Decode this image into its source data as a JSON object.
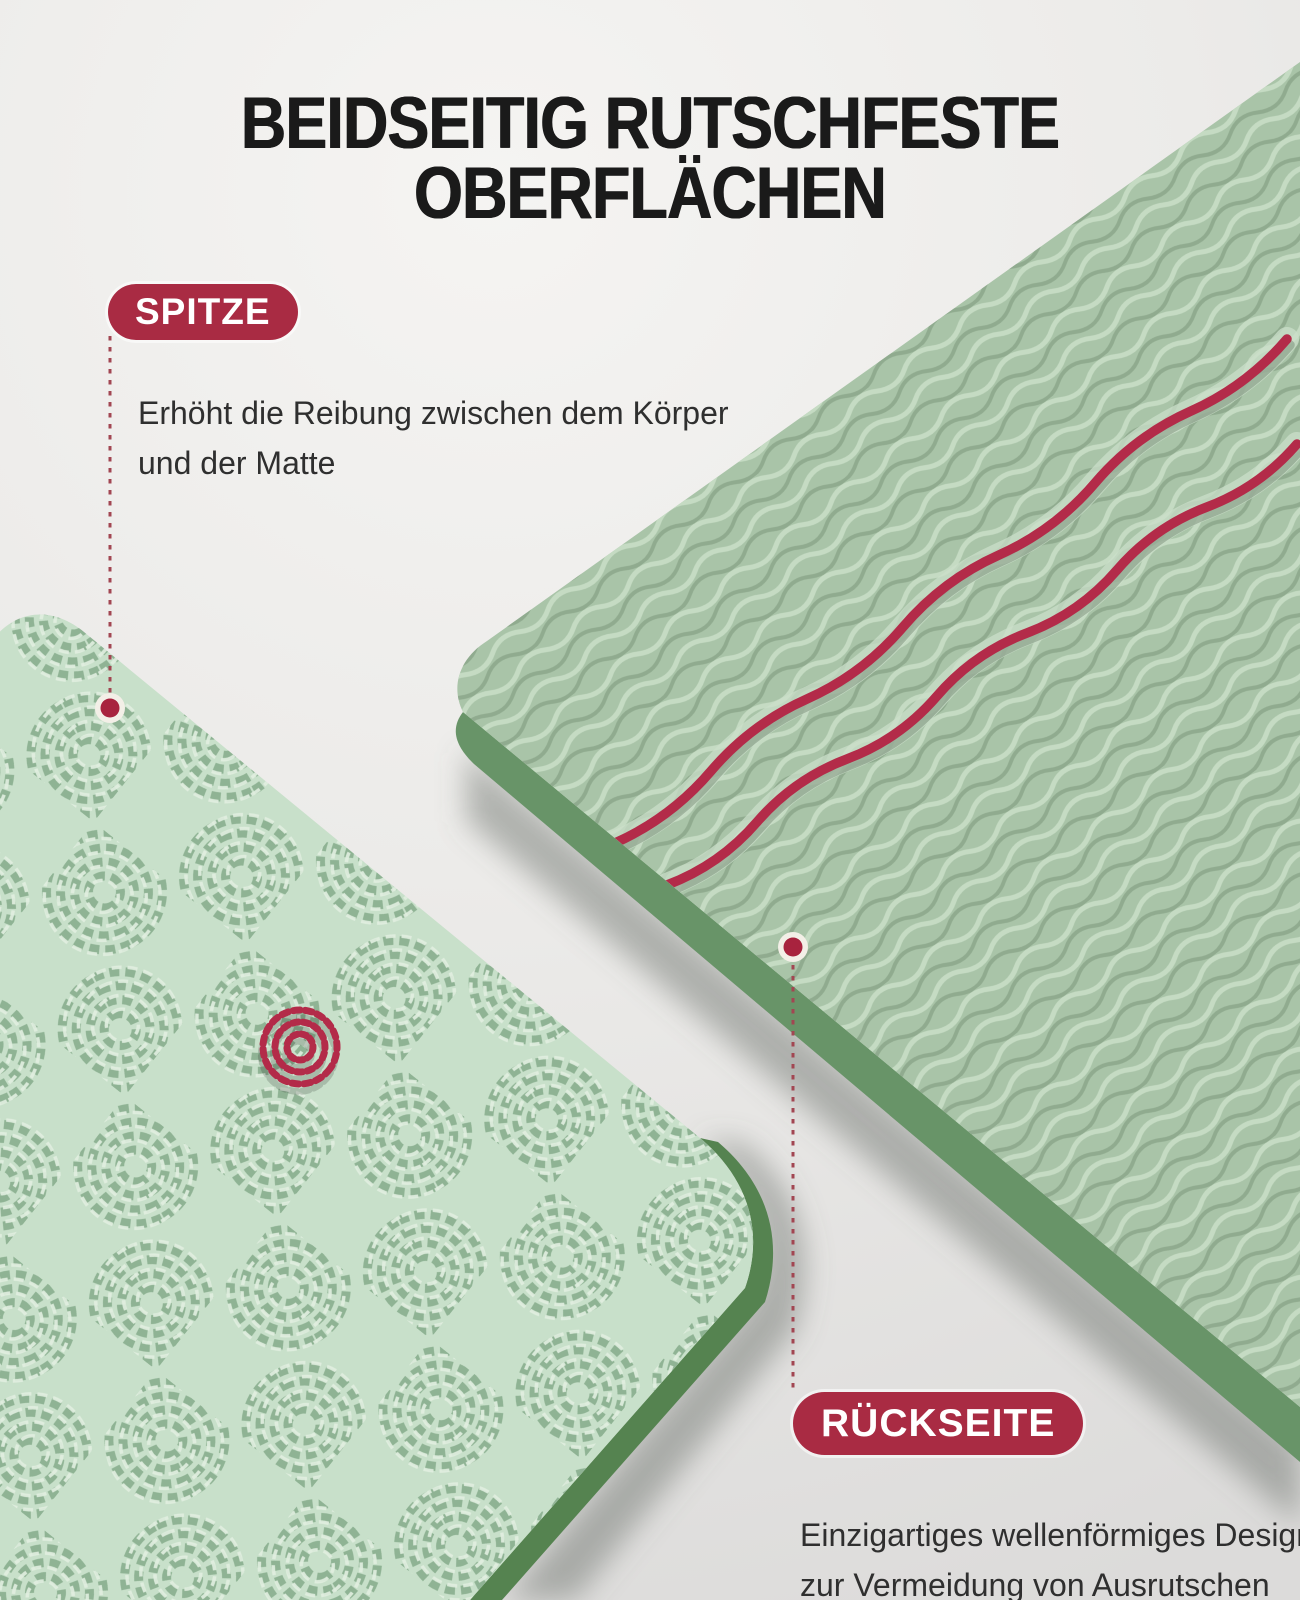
{
  "title": {
    "line1": "BEIDSEITIG RUTSCHFESTE",
    "line2": "OBERFLÄCHEN"
  },
  "callouts": {
    "spitze": {
      "label": "SPITZE",
      "description": "Erhöht die Reibung zwischen dem Körper und der Matte"
    },
    "rueckseite": {
      "label": "RÜCKSEITE",
      "description": "Einzigartiges wellenförmiges Design zur Vermeidung von Ausrutschen"
    }
  },
  "icons": {
    "callout_marker": "filled-circle",
    "leader_line": "dashed-vertical-line",
    "highlighted_tread": "red mesh tread motif on front mat",
    "wavy_stripes": "two red wavy lines on back mat"
  },
  "colors": {
    "accent_red": "#a92b43",
    "marker_red": "#a8233e",
    "leader_red": "#a24652",
    "stripe_red": "#b32b49",
    "title_text": "#1a1a1a",
    "body_text": "#2f2f2f",
    "pill_text": "#ffffff",
    "marker_halo": "#f3efe7",
    "front_mat_base": "#c8e0ca",
    "front_mat_pattern": "#8fb394",
    "front_mat_pattern_light": "#e2efe0",
    "front_mat_edge": "#558350",
    "back_mat_base": "#a9c4a8",
    "back_mat_wave_light": "#c5dbc3",
    "back_mat_wave_dark": "#8ca78b",
    "back_mat_edge": "#689468",
    "groove": "#cbdfc9"
  }
}
